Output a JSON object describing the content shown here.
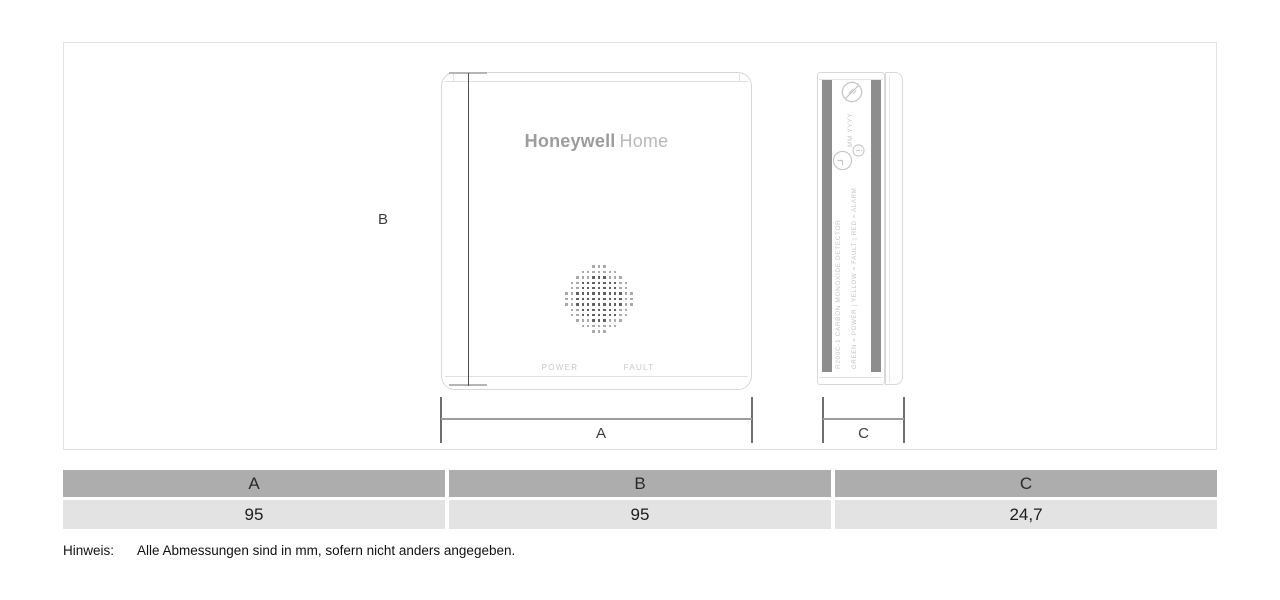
{
  "front_view": {
    "brand_bold": "Honeywell",
    "brand_light": "Home",
    "power_label": "POWER",
    "fault_label": "FAULT"
  },
  "side_view": {
    "date_placeholder": "MM  YYYY",
    "model_line": "R200C-1   CARBON MONOXIDE DETECTOR",
    "led_legend_line": "GREEN = POWER | YELLOW = FAULT | RED = ALARM",
    "icons": [
      "no-tools-icon",
      "clock-icon",
      "info-icon"
    ]
  },
  "dimension_labels": {
    "a": "A",
    "b": "B",
    "c": "C"
  },
  "table": {
    "headers": [
      "A",
      "B",
      "C"
    ],
    "values": [
      "95",
      "95",
      "24,7"
    ]
  },
  "note": {
    "label": "Hinweis:",
    "text": "Alle Abmessungen sind in mm, sofern nicht anders angegeben."
  },
  "colors": {
    "table_header_bg": "#adadad",
    "table_row_bg": "#e3e3e3",
    "device_outline": "#d8d8d8",
    "side_strip": "#8d8d8d",
    "brand_gray": "#9c9c9c",
    "dim_line_dark": "#4f4f4f",
    "dim_line_light": "#9e9e9e",
    "grille_dot_dark": "#616161",
    "grille_dot_light": "#a9a9a9"
  }
}
